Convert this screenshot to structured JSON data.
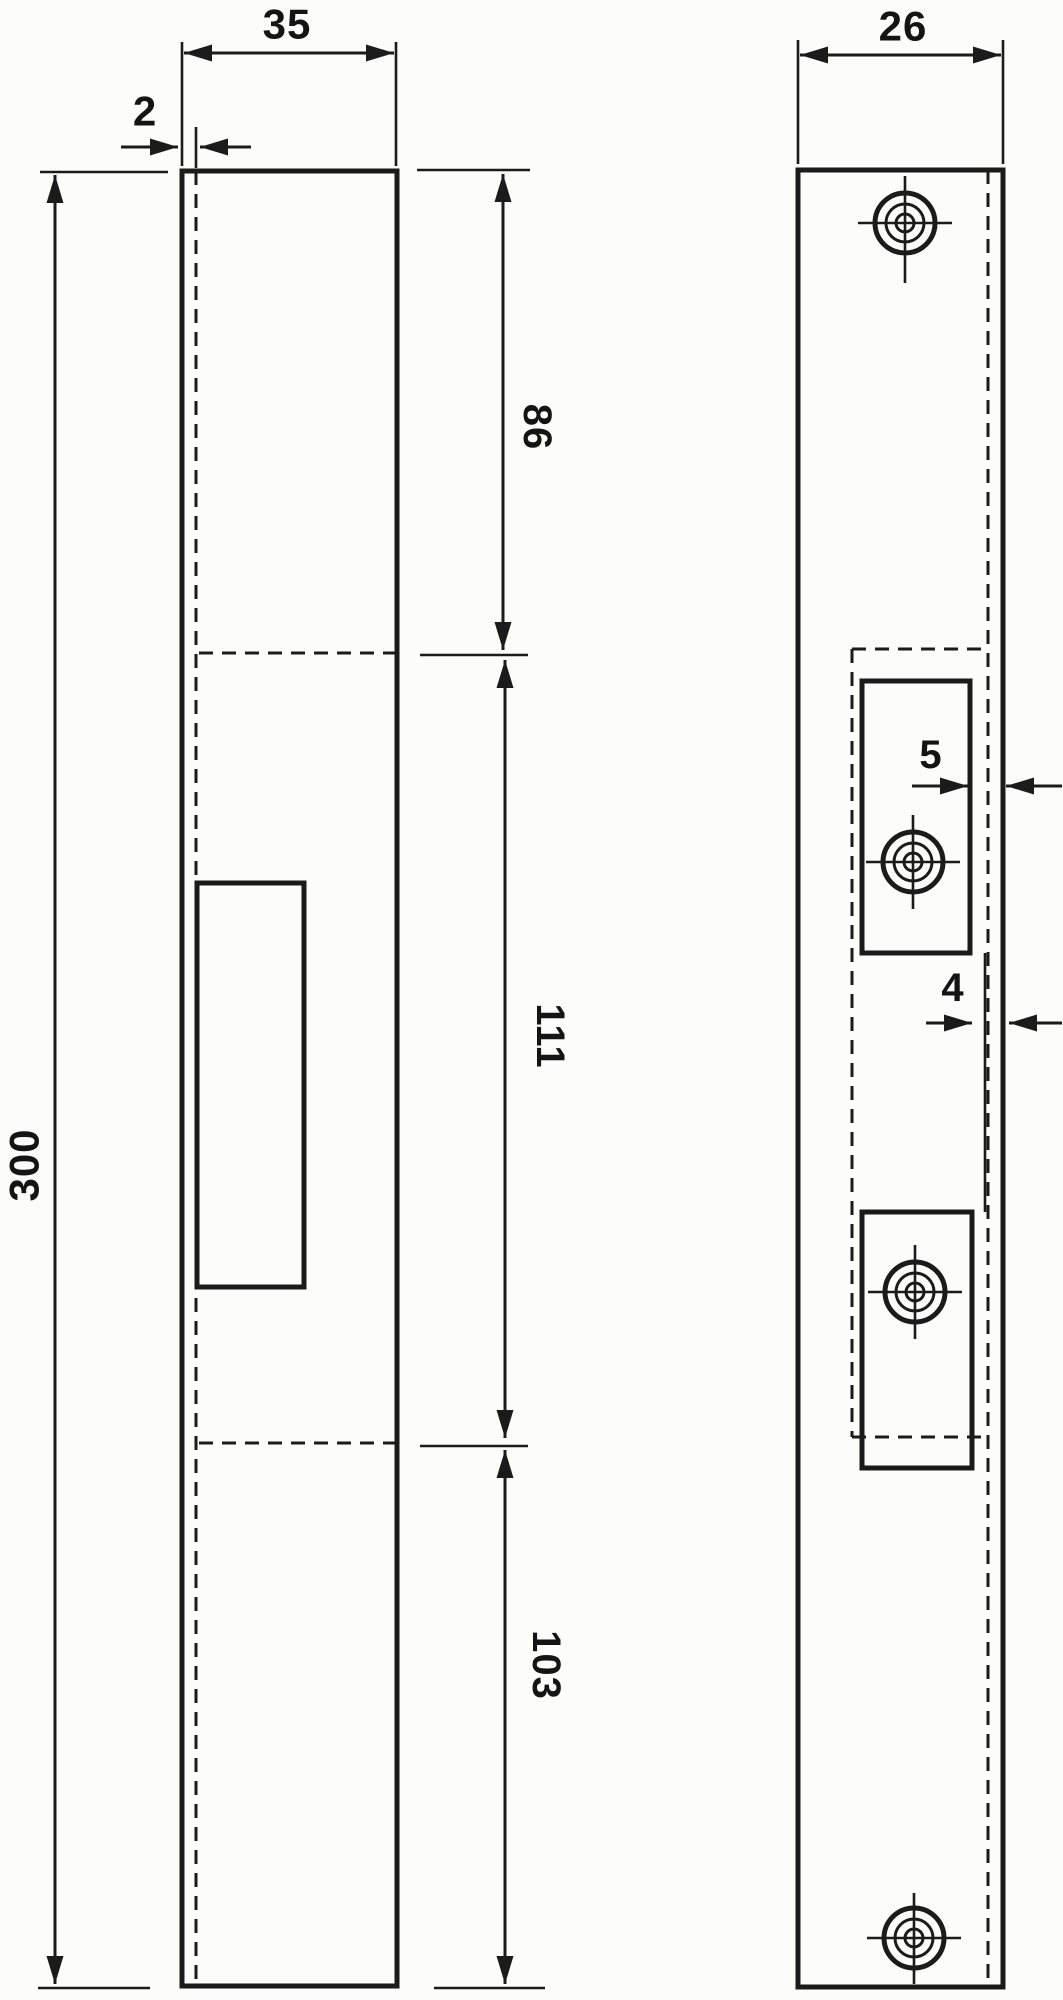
{
  "meta": {
    "drawing_type": "technical-drawing",
    "subject": "door strike plate, two orthographic views",
    "ink_color": "#1b1b1b",
    "background_color": "#fcfcfb",
    "units_shown": "mm (implied, unlabeled)"
  },
  "dimensions": {
    "left_view": {
      "width": "35",
      "thickness": "2",
      "height": "300",
      "top_section": "86",
      "middle_section": "111",
      "bottom_section": "103"
    },
    "right_view": {
      "width": "26",
      "keeper_inset": "5",
      "edge_inset": "4"
    }
  }
}
